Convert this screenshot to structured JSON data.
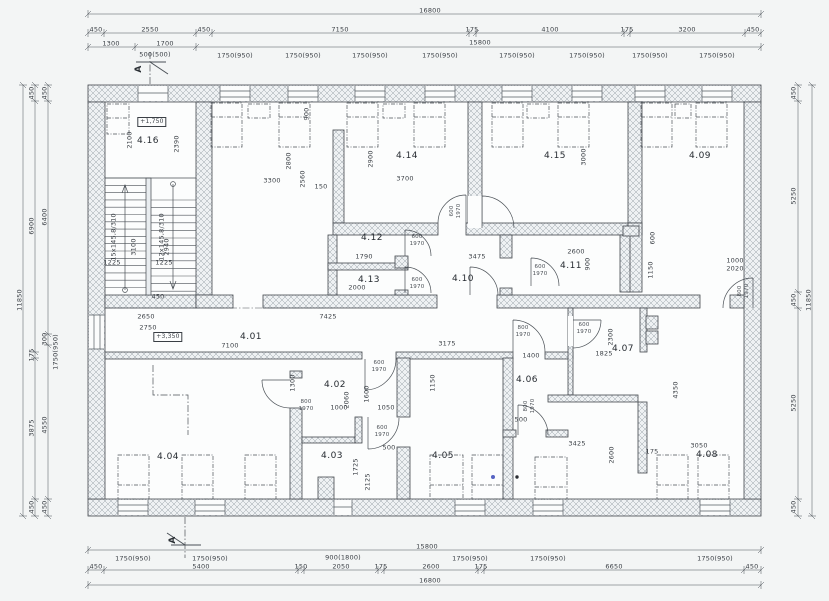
{
  "drawing": {
    "type": "architectural floor plan",
    "rooms": [
      {
        "id": "4.01",
        "x": 251,
        "y": 338
      },
      {
        "id": "4.02",
        "x": 335,
        "y": 386
      },
      {
        "id": "4.03",
        "x": 332,
        "y": 457
      },
      {
        "id": "4.04",
        "x": 168,
        "y": 458
      },
      {
        "id": "4.05",
        "x": 443,
        "y": 457
      },
      {
        "id": "4.06",
        "x": 527,
        "y": 381
      },
      {
        "id": "4.07",
        "x": 623,
        "y": 350
      },
      {
        "id": "4.08",
        "x": 707,
        "y": 456
      },
      {
        "id": "4.09",
        "x": 700,
        "y": 157
      },
      {
        "id": "4.10",
        "x": 463,
        "y": 280
      },
      {
        "id": "4.11",
        "x": 571,
        "y": 267
      },
      {
        "id": "4.12",
        "x": 372,
        "y": 239
      },
      {
        "id": "4.13",
        "x": 369,
        "y": 281
      },
      {
        "id": "4.14",
        "x": 407,
        "y": 157
      },
      {
        "id": "4.15",
        "x": 555,
        "y": 157
      },
      {
        "id": "4.16",
        "x": 148,
        "y": 142
      }
    ],
    "level_markers": [
      {
        "text": "+1,750",
        "x": 152,
        "y": 122
      },
      {
        "text": "+3,350",
        "x": 168,
        "y": 337
      }
    ],
    "section_markers": [
      {
        "text": "A",
        "x": 140,
        "y": 69
      },
      {
        "text": "A",
        "x": 174,
        "y": 540
      }
    ],
    "annotations": [
      {
        "t": "16800",
        "x": 430,
        "y": 11
      },
      {
        "t": "450",
        "x": 96,
        "y": 30
      },
      {
        "t": "2550",
        "x": 150,
        "y": 30
      },
      {
        "t": "450",
        "x": 204,
        "y": 30
      },
      {
        "t": "7150",
        "x": 340,
        "y": 30
      },
      {
        "t": "175",
        "x": 472,
        "y": 30
      },
      {
        "t": "4100",
        "x": 550,
        "y": 30
      },
      {
        "t": "175",
        "x": 627,
        "y": 30
      },
      {
        "t": "3200",
        "x": 687,
        "y": 30
      },
      {
        "t": "450",
        "x": 753,
        "y": 30
      },
      {
        "t": "1300",
        "x": 111,
        "y": 44
      },
      {
        "t": "1700",
        "x": 165,
        "y": 44
      },
      {
        "t": "15800",
        "x": 480,
        "y": 43
      },
      {
        "t": "500(500)",
        "x": 155,
        "y": 55
      },
      {
        "t": "1750(950)",
        "x": 235,
        "y": 56
      },
      {
        "t": "1750(950)",
        "x": 303,
        "y": 56
      },
      {
        "t": "1750(950)",
        "x": 370,
        "y": 56
      },
      {
        "t": "1750(950)",
        "x": 440,
        "y": 56
      },
      {
        "t": "1750(950)",
        "x": 517,
        "y": 56
      },
      {
        "t": "1750(950)",
        "x": 587,
        "y": 56
      },
      {
        "t": "1750(950)",
        "x": 650,
        "y": 56
      },
      {
        "t": "1750(950)",
        "x": 717,
        "y": 56
      },
      {
        "t": "11850",
        "x": 20,
        "y": 300,
        "r": 1
      },
      {
        "t": "450",
        "x": 32,
        "y": 93,
        "r": 1
      },
      {
        "t": "6900",
        "x": 32,
        "y": 226,
        "r": 1
      },
      {
        "t": "175",
        "x": 32,
        "y": 355,
        "r": 1
      },
      {
        "t": "3875",
        "x": 32,
        "y": 428,
        "r": 1
      },
      {
        "t": "450",
        "x": 32,
        "y": 507,
        "r": 1
      },
      {
        "t": "450",
        "x": 45,
        "y": 93,
        "r": 1
      },
      {
        "t": "6400",
        "x": 45,
        "y": 217,
        "r": 1
      },
      {
        "t": "300",
        "x": 45,
        "y": 339,
        "r": 1
      },
      {
        "t": "1750(950)",
        "x": 56,
        "y": 352,
        "r": 1
      },
      {
        "t": "4550",
        "x": 45,
        "y": 425,
        "r": 1
      },
      {
        "t": "450",
        "x": 45,
        "y": 507,
        "r": 1
      },
      {
        "t": "450",
        "x": 794,
        "y": 93,
        "r": 1
      },
      {
        "t": "5250",
        "x": 794,
        "y": 196,
        "r": 1
      },
      {
        "t": "450",
        "x": 794,
        "y": 300,
        "r": 1
      },
      {
        "t": "5250",
        "x": 794,
        "y": 403,
        "r": 1
      },
      {
        "t": "450",
        "x": 794,
        "y": 507,
        "r": 1
      },
      {
        "t": "11850",
        "x": 809,
        "y": 300,
        "r": 1
      },
      {
        "t": "15800",
        "x": 427,
        "y": 547
      },
      {
        "t": "1750(950)",
        "x": 133,
        "y": 559
      },
      {
        "t": "1750(950)",
        "x": 210,
        "y": 559
      },
      {
        "t": "900(1800)",
        "x": 343,
        "y": 558
      },
      {
        "t": "1750(950)",
        "x": 470,
        "y": 559
      },
      {
        "t": "1750(950)",
        "x": 548,
        "y": 559
      },
      {
        "t": "1750(950)",
        "x": 715,
        "y": 559
      },
      {
        "t": "450",
        "x": 96,
        "y": 567
      },
      {
        "t": "5400",
        "x": 201,
        "y": 567
      },
      {
        "t": "150",
        "x": 301,
        "y": 567
      },
      {
        "t": "2050",
        "x": 341,
        "y": 567
      },
      {
        "t": "175",
        "x": 381,
        "y": 567
      },
      {
        "t": "2600",
        "x": 431,
        "y": 567
      },
      {
        "t": "175",
        "x": 481,
        "y": 567
      },
      {
        "t": "6650",
        "x": 614,
        "y": 567
      },
      {
        "t": "450",
        "x": 752,
        "y": 567
      },
      {
        "t": "16800",
        "x": 430,
        "y": 581
      },
      {
        "t": "2100",
        "x": 130,
        "y": 140,
        "r": 1
      },
      {
        "t": "2390",
        "x": 177,
        "y": 144,
        "r": 1
      },
      {
        "t": "3300",
        "x": 272,
        "y": 181
      },
      {
        "t": "2560",
        "x": 303,
        "y": 179,
        "r": 1
      },
      {
        "t": "3700",
        "x": 405,
        "y": 179
      },
      {
        "t": "900",
        "x": 307,
        "y": 114,
        "r": 1
      },
      {
        "t": "2800",
        "x": 289,
        "y": 161,
        "r": 1
      },
      {
        "t": "2900",
        "x": 371,
        "y": 159,
        "r": 1
      },
      {
        "t": "3000",
        "x": 584,
        "y": 157,
        "r": 1
      },
      {
        "t": "150",
        "x": 321,
        "y": 187
      },
      {
        "t": "1790",
        "x": 364,
        "y": 257
      },
      {
        "t": "3475",
        "x": 477,
        "y": 257
      },
      {
        "t": "2000",
        "x": 357,
        "y": 288
      },
      {
        "t": "2600",
        "x": 576,
        "y": 252
      },
      {
        "t": "900",
        "x": 588,
        "y": 264,
        "r": 1
      },
      {
        "t": "1150",
        "x": 651,
        "y": 270,
        "r": 1
      },
      {
        "t": "600",
        "x": 653,
        "y": 238,
        "r": 1
      },
      {
        "t": "1000",
        "x": 735,
        "y": 261
      },
      {
        "t": "2020",
        "x": 735,
        "y": 269
      },
      {
        "t": "2650",
        "x": 146,
        "y": 317
      },
      {
        "t": "2750",
        "x": 148,
        "y": 328
      },
      {
        "t": "7425",
        "x": 328,
        "y": 317
      },
      {
        "t": "7100",
        "x": 230,
        "y": 346
      },
      {
        "t": "3175",
        "x": 447,
        "y": 344
      },
      {
        "t": "1400",
        "x": 531,
        "y": 356
      },
      {
        "t": "1825",
        "x": 604,
        "y": 354
      },
      {
        "t": "2300",
        "x": 611,
        "y": 337,
        "r": 1
      },
      {
        "t": "1600",
        "x": 367,
        "y": 394,
        "r": 1
      },
      {
        "t": "2060",
        "x": 347,
        "y": 400,
        "r": 1
      },
      {
        "t": "1000",
        "x": 339,
        "y": 408
      },
      {
        "t": "1050",
        "x": 386,
        "y": 408
      },
      {
        "t": "1150",
        "x": 433,
        "y": 383,
        "r": 1
      },
      {
        "t": "1300",
        "x": 293,
        "y": 383,
        "r": 1
      },
      {
        "t": "1725",
        "x": 356,
        "y": 467,
        "r": 1
      },
      {
        "t": "2125",
        "x": 368,
        "y": 482,
        "r": 1
      },
      {
        "t": "500",
        "x": 389,
        "y": 448
      },
      {
        "t": "500",
        "x": 521,
        "y": 420
      },
      {
        "t": "3425",
        "x": 577,
        "y": 444
      },
      {
        "t": "3050",
        "x": 699,
        "y": 446
      },
      {
        "t": "2600",
        "x": 612,
        "y": 455,
        "r": 1
      },
      {
        "t": "175",
        "x": 652,
        "y": 452
      },
      {
        "t": "4350",
        "x": 676,
        "y": 390,
        "r": 1
      },
      {
        "t": "1225",
        "x": 112,
        "y": 263
      },
      {
        "t": "1225",
        "x": 164,
        "y": 263
      },
      {
        "t": "3100",
        "x": 134,
        "y": 247,
        "r": 1
      },
      {
        "t": "2940",
        "x": 167,
        "y": 247,
        "r": 1
      },
      {
        "t": "450",
        "x": 158,
        "y": 297
      },
      {
        "t": "15x145,8/310",
        "x": 114,
        "y": 237,
        "r": 1
      },
      {
        "t": "12x145,8/310",
        "x": 162,
        "y": 237,
        "r": 1
      },
      {
        "t": "600",
        "x": 417,
        "y": 237,
        "s": "xs"
      },
      {
        "t": "1970",
        "x": 417,
        "y": 244,
        "s": "xs"
      },
      {
        "t": "600",
        "x": 417,
        "y": 280,
        "s": "xs"
      },
      {
        "t": "1970",
        "x": 417,
        "y": 287,
        "s": "xs"
      },
      {
        "t": "600",
        "x": 452,
        "y": 211,
        "r": 1,
        "s": "xs"
      },
      {
        "t": "1970",
        "x": 459,
        "y": 211,
        "r": 1,
        "s": "xs"
      },
      {
        "t": "600",
        "x": 540,
        "y": 267,
        "s": "xs"
      },
      {
        "t": "1970",
        "x": 540,
        "y": 274,
        "s": "xs"
      },
      {
        "t": "600",
        "x": 379,
        "y": 363,
        "s": "xs"
      },
      {
        "t": "1970",
        "x": 379,
        "y": 370,
        "s": "xs"
      },
      {
        "t": "800",
        "x": 523,
        "y": 328,
        "s": "xs"
      },
      {
        "t": "1970",
        "x": 523,
        "y": 335,
        "s": "xs"
      },
      {
        "t": "600",
        "x": 584,
        "y": 325,
        "s": "xs"
      },
      {
        "t": "1970",
        "x": 584,
        "y": 332,
        "s": "xs"
      },
      {
        "t": "600",
        "x": 382,
        "y": 428,
        "s": "xs"
      },
      {
        "t": "1970",
        "x": 382,
        "y": 435,
        "s": "xs"
      },
      {
        "t": "800",
        "x": 740,
        "y": 291,
        "r": 1,
        "s": "xs"
      },
      {
        "t": "1970",
        "x": 747,
        "y": 291,
        "r": 1,
        "s": "xs"
      },
      {
        "t": "800",
        "x": 526,
        "y": 406,
        "r": 1,
        "s": "xs"
      },
      {
        "t": "1970",
        "x": 533,
        "y": 406,
        "r": 1,
        "s": "xs"
      },
      {
        "t": "800",
        "x": 306,
        "y": 402,
        "s": "xs"
      },
      {
        "t": "1970",
        "x": 306,
        "y": 409,
        "s": "xs"
      }
    ]
  }
}
